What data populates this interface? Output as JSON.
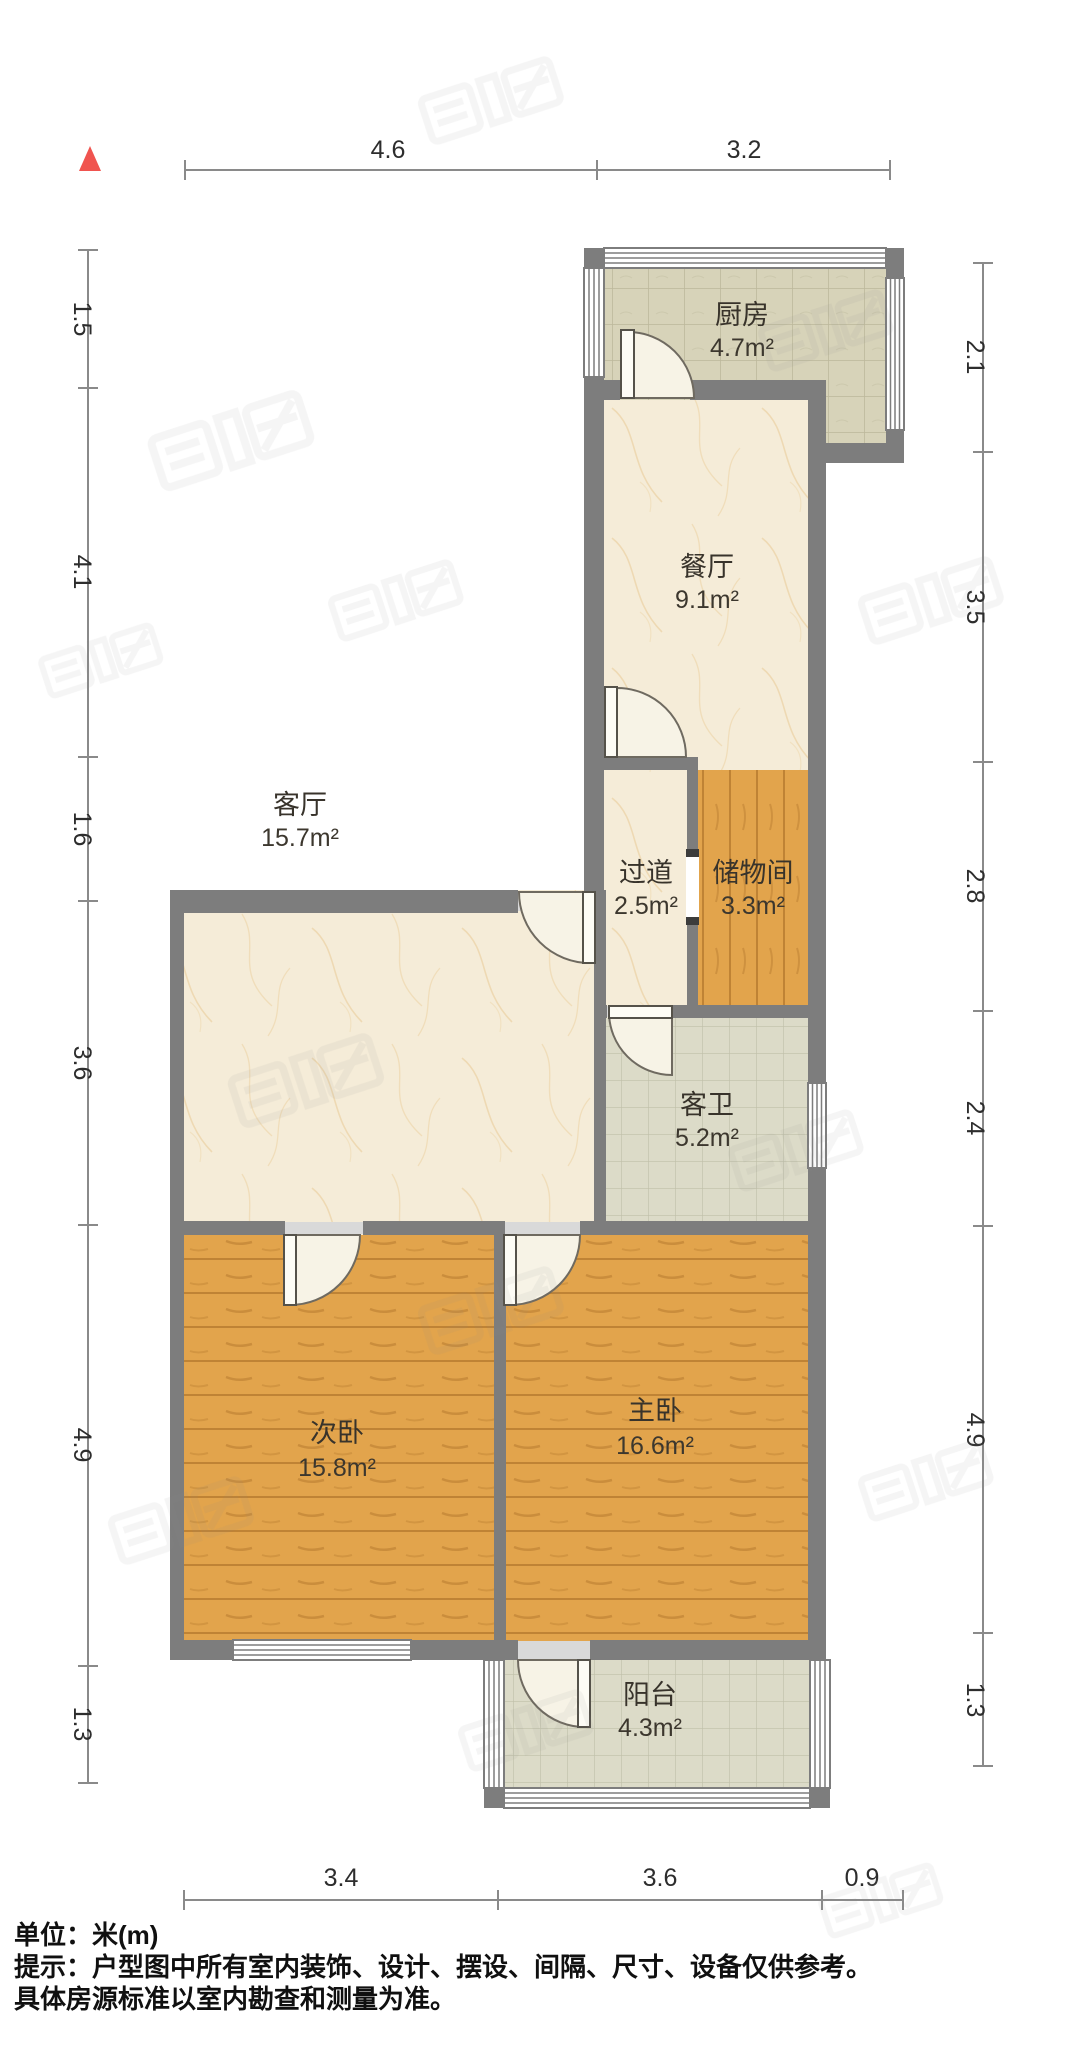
{
  "rooms": [
    {
      "id": "kitchen",
      "name": "厨房",
      "area": "4.7m²"
    },
    {
      "id": "dining",
      "name": "餐厅",
      "area": "9.1m²"
    },
    {
      "id": "hallway",
      "name": "过道",
      "area": "2.5m²"
    },
    {
      "id": "storage",
      "name": "储物间",
      "area": "3.3m²"
    },
    {
      "id": "living",
      "name": "客厅",
      "area": "15.7m²"
    },
    {
      "id": "guest-bath",
      "name": "客卫",
      "area": "5.2m²"
    },
    {
      "id": "second-bedroom",
      "name": "次卧",
      "area": "15.8m²"
    },
    {
      "id": "master-bedroom",
      "name": "主卧",
      "area": "16.6m²"
    },
    {
      "id": "balcony",
      "name": "阳台",
      "area": "4.3m²"
    }
  ],
  "dimensions": {
    "top": [
      "4.6",
      "3.2"
    ],
    "bottom": [
      "3.4",
      "3.6",
      "0.9"
    ],
    "left": [
      "1.5",
      "4.1",
      "1.6",
      "3.6",
      "4.9",
      "1.3"
    ],
    "right": [
      "2.1",
      "3.5",
      "2.8",
      "2.4",
      "4.9",
      "1.3"
    ]
  },
  "footer": {
    "unit": "单位：米(m)",
    "tip1": "提示：户型图中所有室内装饰、设计、摆设、间隔、尺寸、设备仅供参考。",
    "tip2": "具体房源标准以室内勘查和测量为准。"
  },
  "colors": {
    "wall": "#7d7d7d",
    "wood_floor": "#e2a44c",
    "kitchen_tile": "#d7d3b9",
    "bath_tile": "#dcdbc8",
    "marble_floor": "#f5ecd8",
    "north_marker": "#f0544f",
    "dimension_line": "#8a8a8a"
  }
}
